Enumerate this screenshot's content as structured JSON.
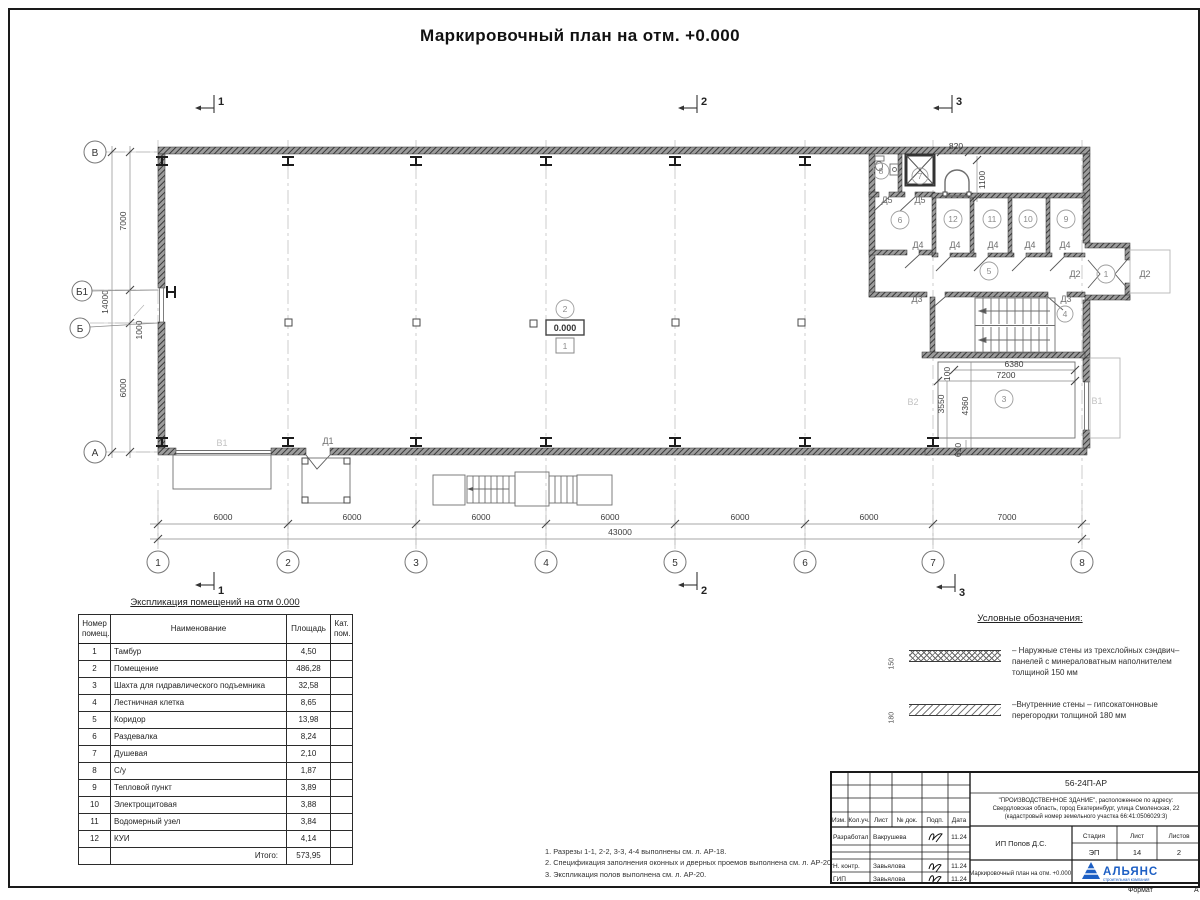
{
  "sheet": {
    "title": "Маркировочный план на отм. +0.000",
    "format_label": "Формат",
    "format_value": "А"
  },
  "plan": {
    "section_marks": [
      "1",
      "2",
      "3"
    ],
    "grid_rows": [
      "В",
      "Б1",
      "Б",
      "А"
    ],
    "grid_cols": [
      "1",
      "2",
      "3",
      "4",
      "5",
      "6",
      "7",
      "8"
    ],
    "dims_bottom": [
      "6000",
      "6000",
      "6000",
      "6000",
      "6000",
      "6000",
      "7000"
    ],
    "dim_total_bottom": "43000",
    "dims_left": [
      "7000",
      "1000",
      "6000"
    ],
    "dim_total_left": "14000",
    "rooms": [
      "1",
      "2",
      "3",
      "4",
      "5",
      "6",
      "7",
      "8",
      "9",
      "10",
      "11",
      "12"
    ],
    "doors": {
      "d1": "Д1",
      "d2": "Д2",
      "d3": "Д3",
      "d4": "Д4",
      "d5": "Д5"
    },
    "windows": {
      "v1": "В1",
      "v2": "В2"
    },
    "detail_dims": {
      "w820": "820",
      "h1100": "1100",
      "w6380": "6380",
      "w7200": "7200",
      "h100": "100",
      "h3550": "3550",
      "h4360": "4360",
      "h610": "610"
    },
    "elevation": "0.000",
    "floor_tag": "1"
  },
  "explication": {
    "title": "Экспликация помещений на отм 0.000",
    "headers": {
      "num": "Номер помещ.",
      "name": "Наименование",
      "area": "Площадь",
      "cat": "Кат. пом."
    },
    "rows": [
      {
        "num": "1",
        "name": "Тамбур",
        "area": "4,50",
        "cat": ""
      },
      {
        "num": "2",
        "name": "Помещение",
        "area": "486,28",
        "cat": ""
      },
      {
        "num": "3",
        "name": "Шахта для гидравлического подъемника",
        "area": "32,58",
        "cat": ""
      },
      {
        "num": "4",
        "name": "Лестничная клетка",
        "area": "8,65",
        "cat": ""
      },
      {
        "num": "5",
        "name": "Коридор",
        "area": "13,98",
        "cat": ""
      },
      {
        "num": "6",
        "name": "Раздевалка",
        "area": "8,24",
        "cat": ""
      },
      {
        "num": "7",
        "name": "Душевая",
        "area": "2,10",
        "cat": ""
      },
      {
        "num": "8",
        "name": "С/у",
        "area": "1,87",
        "cat": ""
      },
      {
        "num": "9",
        "name": "Тепловой пункт",
        "area": "3,89",
        "cat": ""
      },
      {
        "num": "10",
        "name": "Электрощитовая",
        "area": "3,88",
        "cat": ""
      },
      {
        "num": "11",
        "name": "Водомерный узел",
        "area": "3,84",
        "cat": ""
      },
      {
        "num": "12",
        "name": "КУИ",
        "area": "4,14",
        "cat": ""
      }
    ],
    "total_label": "Итого:",
    "total_value": "573,95"
  },
  "legend": {
    "title": "Условные обозначения:",
    "items": [
      {
        "dim": "150",
        "text": "– Наружные стены из трехслойных сэндвич–панелей с минераловатным наполнителем толщиной 150 мм"
      },
      {
        "dim": "180",
        "text": "–Внутренние стены – гипсокатонновые перегородки толщиной 180 мм"
      }
    ]
  },
  "notes": [
    "1. Разрезы 1-1, 2-2, 3-3, 4-4 выполнены см. л. АР-18.",
    "2. Спецификация заполнения оконных и дверных проемов выполнена см. л. АР-20.",
    "3. Экспликация полов выполнена см. л. АР-20."
  ],
  "titleblock": {
    "doc_number": "56-24П-АР",
    "description_lines": [
      "\"ПРОИЗВОДСТВЕННОЕ ЗДАНИЕ\", расположенное по адресу:",
      "Свердловская область, город Екатеринбург, улица Смоленская, 22",
      "(кадастровый номер земельного участка 66:41:0506029:3)"
    ],
    "header_cols": [
      "Изм.",
      "Кол.уч.",
      "Лист",
      "№ док.",
      "Подп.",
      "Дата"
    ],
    "people": [
      {
        "role": "Разработал",
        "name": "Вакрушева",
        "date": "11.24"
      },
      {
        "role": "Н. контр.",
        "name": "Завьялова",
        "date": "11.24"
      },
      {
        "role": "ГИП",
        "name": "Завьялова",
        "date": "11.24"
      }
    ],
    "client": "ИП Попов Д.С.",
    "stage_label": "Стадия",
    "sheet_label": "Лист",
    "sheets_label": "Листов",
    "stage": "ЭП",
    "sheet_num": "14",
    "sheets_total": "2",
    "sheet_title": "Маркировочный план на отм. +0.000.",
    "logo_text": "АЛЬЯНС",
    "logo_sub": "строительная компания"
  }
}
